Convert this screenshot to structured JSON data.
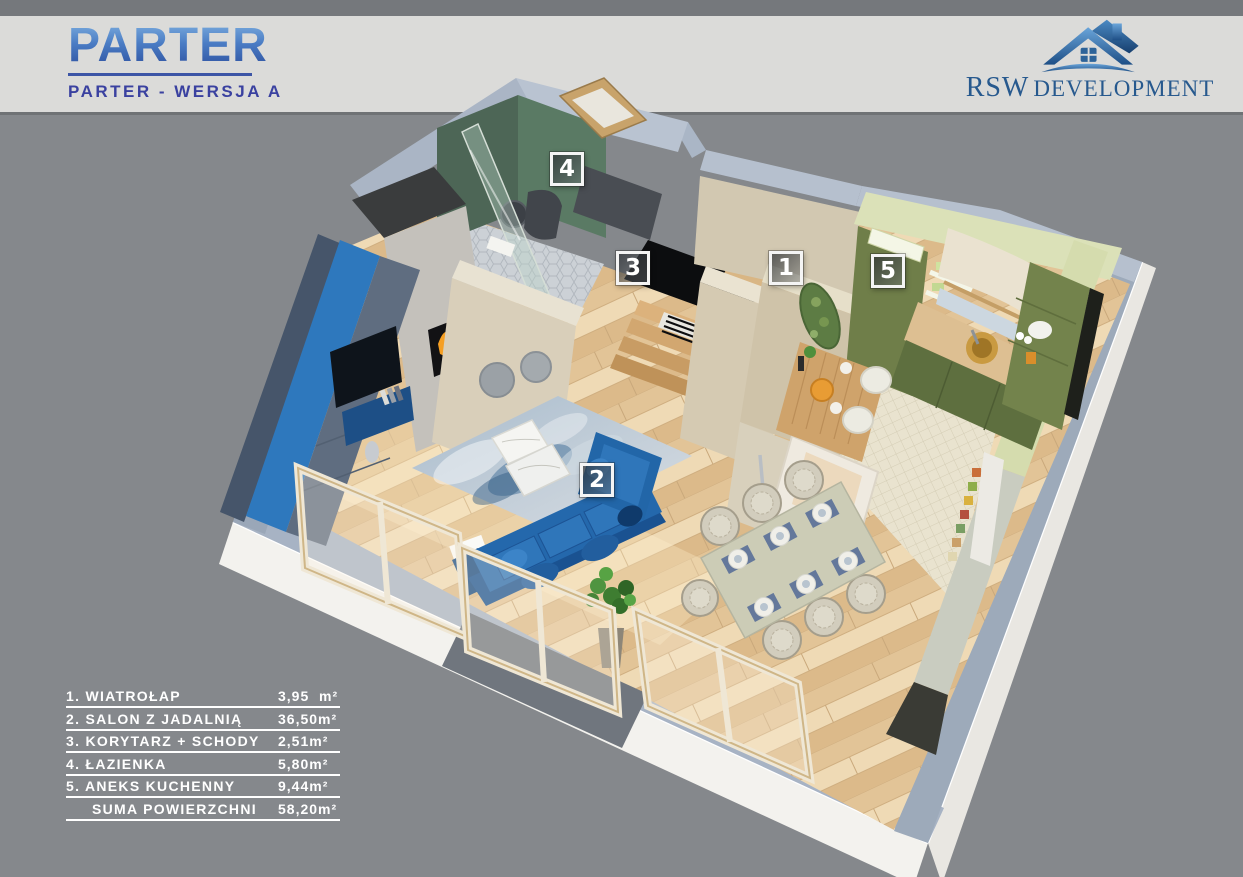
{
  "header": {
    "title": "PARTER",
    "subtitle": "PARTER - WERSJA A"
  },
  "logo": {
    "company_primary": "RSW",
    "company_secondary": "DEVELOPMENT"
  },
  "legend": {
    "items": [
      {
        "number": "1",
        "label": "1. WIATROŁAP",
        "area": "3,95  m²"
      },
      {
        "number": "2",
        "label": "2. SALON Z JADALNIĄ",
        "area": "36,50m²"
      },
      {
        "number": "3",
        "label": "3. KORYTARZ + SCHODY",
        "area": "2,51m²"
      },
      {
        "number": "4",
        "label": "4. ŁAZIENKA",
        "area": "5,80m²"
      },
      {
        "number": "5",
        "label": "5. ANEKS KUCHENNY",
        "area": "9,44m²"
      },
      {
        "number": "",
        "label": "SUMA POWIERZCHNI",
        "area": "58,20m²"
      }
    ]
  },
  "colors": {
    "background": "#85888c",
    "top_strip": "#75787c",
    "header_band": "#dbdbd9",
    "title_blue": "#3d6cb4",
    "subtitle_blue": "#3a41a0",
    "legend_text": "#ffffff",
    "wall_top": "#a7b3c4",
    "plinth_white": "#f3f2ee",
    "wood_floor": "#e8cfa6",
    "bathroom_green": "#5a7a64",
    "kitchen_olive": "#6f7e49",
    "kitchen_pale_top": "#dbe1b8",
    "sofa_blue": "#2468ac",
    "media_wall_blue": "#2e78bd",
    "fire_orange": "#f59f23"
  }
}
